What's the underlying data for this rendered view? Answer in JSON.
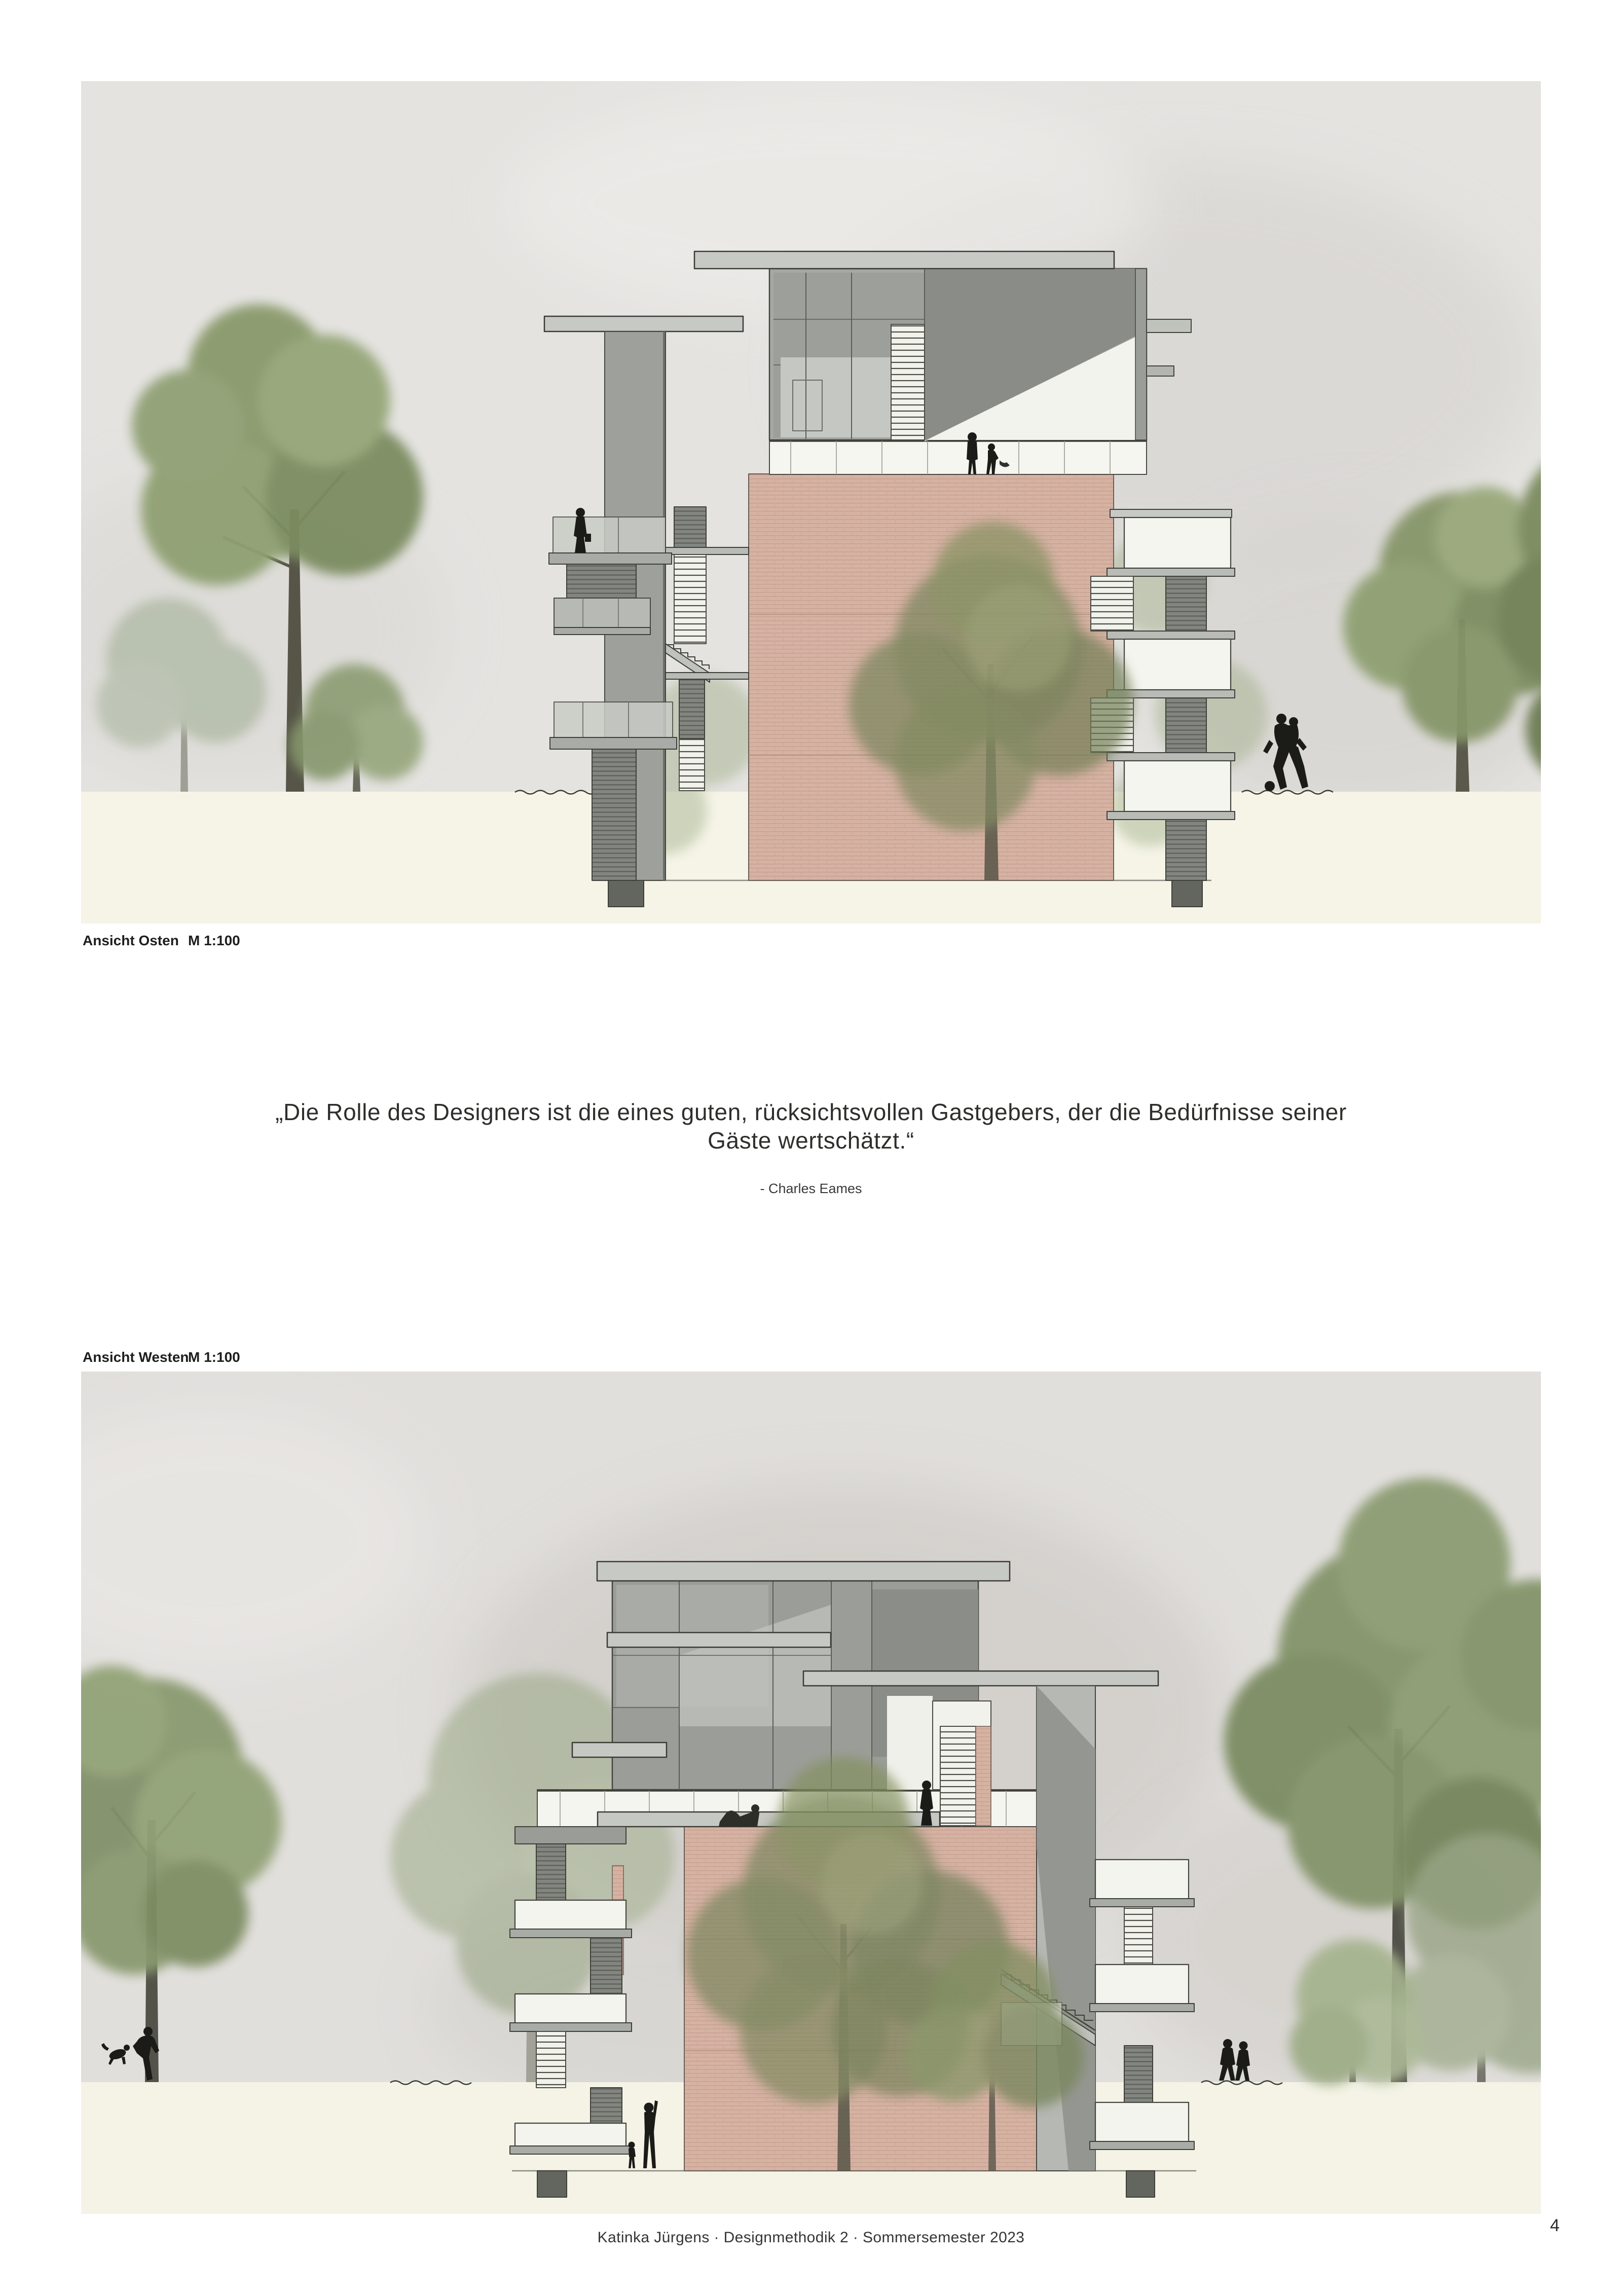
{
  "page": {
    "page_number": "4",
    "background": "#ffffff"
  },
  "elevations": {
    "east": {
      "label": "Ansicht Osten",
      "scale": "M 1:100"
    },
    "west": {
      "label": "Ansicht Westen",
      "scale": "M 1:100"
    }
  },
  "quote": {
    "line1": "„Die Rolle des Designers ist die eines guten, rücksichtsvollen Gastgebers, der die Bedürfnisse seiner",
    "line2": "Gäste wertschätzt.“",
    "attribution": "- Charles Eames"
  },
  "footer": {
    "credit": "Katinka Jürgens · Designmethodik 2 · Sommersemester 2023"
  },
  "palette": {
    "sky_east": "#e4e3e0",
    "sky_west": "#e0dedb",
    "cloud": "#c9c6c1",
    "ground_band": "#f5f4e7",
    "brick_wall": "#d6b2a3",
    "roof_slab": "#c7c9c5",
    "building_block": "#9b9e98",
    "dark_ceiling": "#8a8d87",
    "balcony_white": "#f5f5ef",
    "foliage": "#87976c",
    "trunk": "#565548",
    "silhouette": "#1b1b18"
  }
}
